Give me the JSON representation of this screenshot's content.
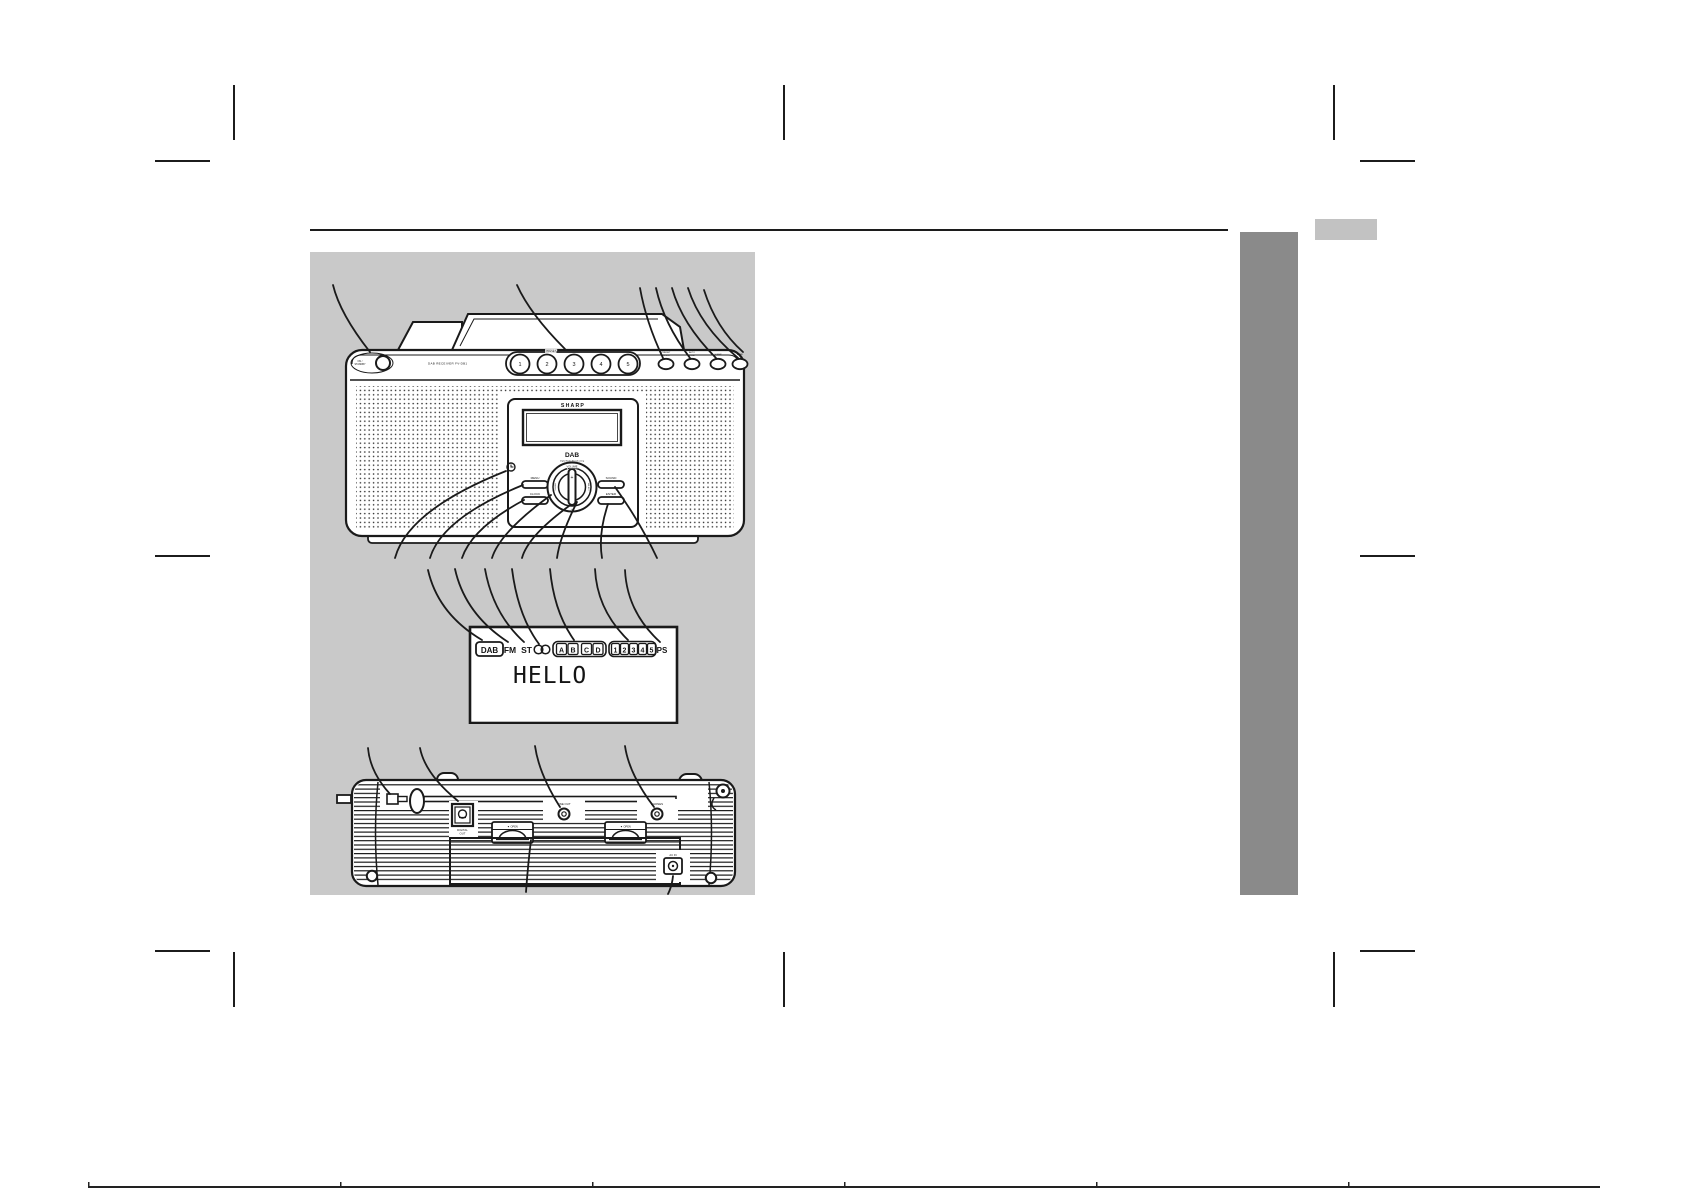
{
  "colors": {
    "panel_bg": "#c9c9c9",
    "sidebar": "#8a8a8a",
    "tab": "#c2c2c2",
    "ink": "#1a1a1a",
    "page": "#ffffff"
  },
  "front_view": {
    "power_label_line1": "ON /",
    "power_label_line2": "STANDBY",
    "model_text": "DAB RECEIVER FV-DB1",
    "preset_label": "PRESET",
    "preset_buttons": [
      "1",
      "2",
      "3",
      "4",
      "5"
    ],
    "top_buttons": [
      {
        "line1": "PRESET",
        "line2": "SELECT"
      },
      {
        "line1": "AUTO",
        "line2": "TUNE"
      },
      {
        "line1": "SLEEP",
        "line2": ""
      },
      {
        "line1": "BAND",
        "line2": ""
      }
    ],
    "panel": {
      "brand": "SHARP",
      "logo": "DAB",
      "logo_sub": "Digital Audio Broadcasting",
      "menu": "MENU",
      "clock": "CLOCK",
      "sound": "SOUND",
      "enter": "ENTER",
      "volume": "VOLUME",
      "plus": "+",
      "minus": "−",
      "tuning": "TUNING",
      "select": "SELECT"
    }
  },
  "display_view": {
    "dab": "DAB",
    "fm": "FM",
    "st": "ST",
    "letters": [
      "A",
      "B",
      "C",
      "D"
    ],
    "digits": [
      "1",
      "2",
      "3",
      "4",
      "5"
    ],
    "ps": "PS",
    "screen_text": "HELLO"
  },
  "rear_view": {
    "digital_out_line1": "DIGITAL",
    "digital_out_line2": "OUT",
    "latch_label": "▼ OPEN",
    "line_out": "LINE OUT",
    "phones": "PHONES",
    "ac_in": "AC IN"
  }
}
